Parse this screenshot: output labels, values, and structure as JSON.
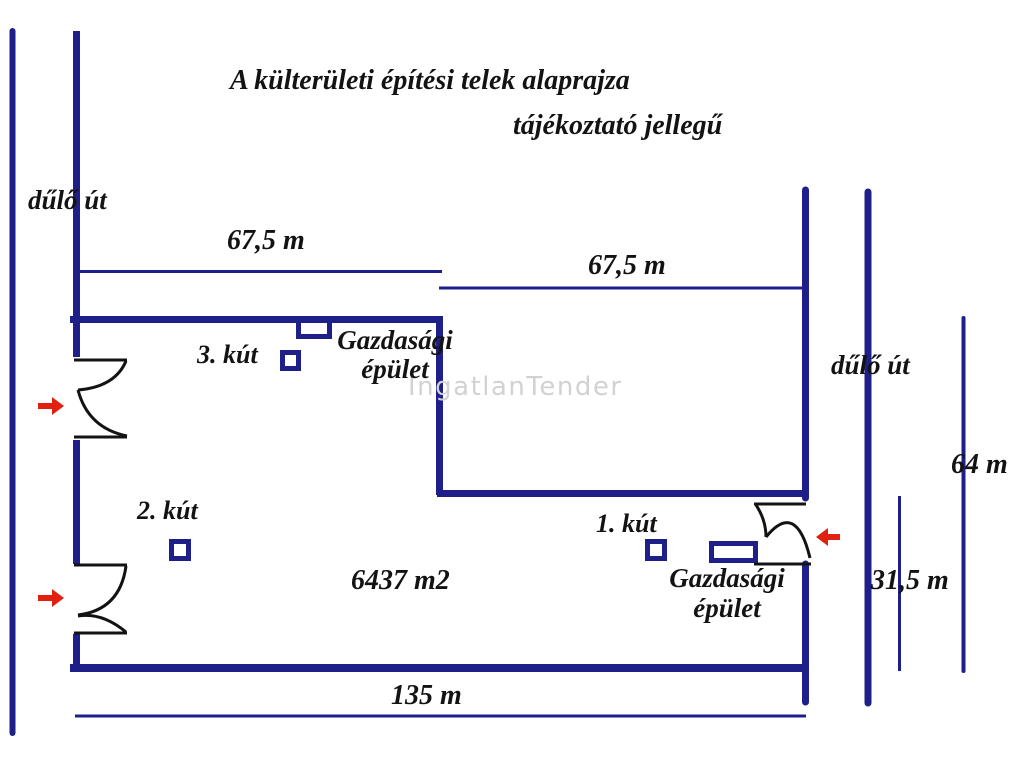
{
  "title": "A külterületi építési telek alaprajza",
  "subtitle": "tájékoztató jellegű",
  "watermark": "IngatlanTender",
  "roads": {
    "left": "dűlő út",
    "right": "dűlő út"
  },
  "dimensions": {
    "top_left_width": "67,5 m",
    "top_right_width": "67,5 m",
    "right_height_total": "64 m",
    "right_height_lower": "31,5 m",
    "bottom_width": "135 m"
  },
  "parcel": {
    "area": "6437 m2"
  },
  "wells": {
    "well1_label": "1. kút",
    "well2_label": "2. kút",
    "well3_label": "3. kút"
  },
  "buildings": {
    "top": {
      "line1": "Gazdasági",
      "line2": "épület"
    },
    "right": {
      "line1": "Gazdasági",
      "line2": "épület"
    }
  },
  "colors": {
    "navy": "#1f1f8a",
    "ink": "#131313",
    "red": "#e02112",
    "watermark": "#d2d2d2"
  }
}
